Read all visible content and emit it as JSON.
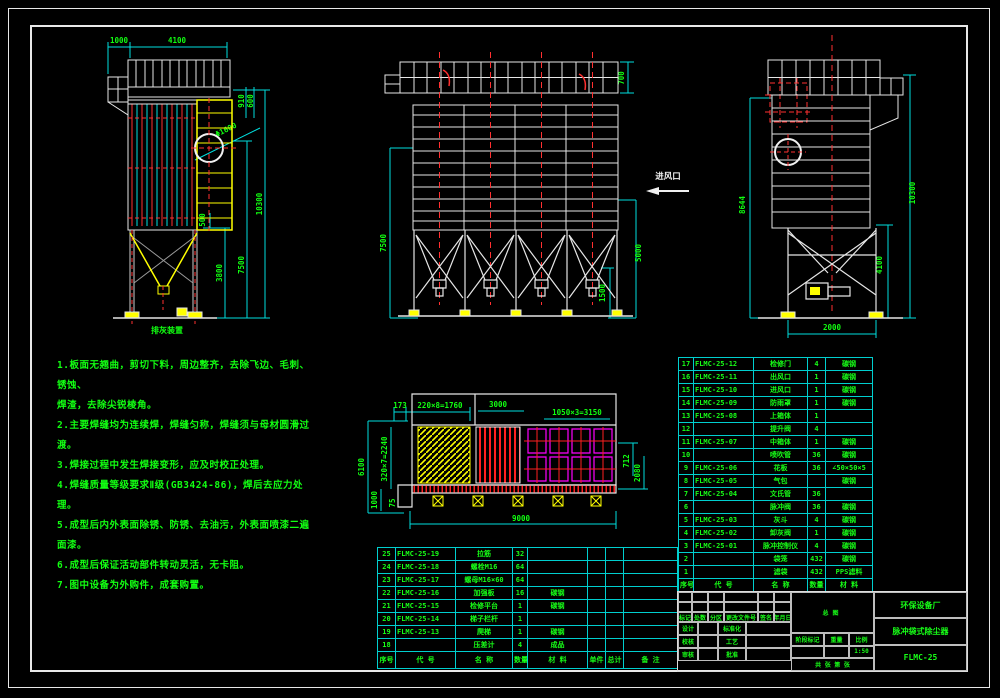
{
  "sheet": {
    "background": "#000000",
    "frame_color": "#e8e8e8",
    "grid_color": "#00cfcf",
    "text_green": "#11ff11",
    "accent_red": "#ff2020",
    "accent_yellow": "#ffff00",
    "accent_magenta": "#ff00ff"
  },
  "views": {
    "left": {
      "caption": "排灰装置",
      "dims": {
        "d1000": "1000",
        "d4100": "4100",
        "d910": "910",
        "d600": "600",
        "phi": "Φ1600",
        "d500": "500",
        "d3800": "3800",
        "d7500": "7500",
        "d10300": "10300"
      }
    },
    "front": {
      "inlet_label": "进风口",
      "dims": {
        "d700": "700",
        "d7500": "7500",
        "d5000": "5000",
        "d1500": "1500"
      }
    },
    "side": {
      "dims": {
        "d8644": "8644",
        "d10300": "10300",
        "d4100": "4100",
        "d2000": "2000"
      }
    },
    "plan": {
      "dims": {
        "d173": "173",
        "d1760": "220×8=1760",
        "d3000": "3000",
        "d3150": "1050×3=3150",
        "d6100": "6100",
        "d2240": "320×7=2240",
        "d1000": "1000",
        "d75": "75",
        "d9000": "9000",
        "d712": "712",
        "d2080": "2080"
      }
    }
  },
  "notes": {
    "lines": [
      "1.板面无翘曲，剪切下料，周边整齐，去除飞边、毛刺、锈蚀、",
      "焊渣，去除尖锐棱角。",
      "2.主要焊缝均为连续焊，焊缝匀称，焊缝须与母材圆滑过渡。",
      "3.焊接过程中发生焊接变形，应及时校正处理。",
      "4.焊缝质量等级要求Ⅱ级(GB3424-86)，焊后去应力处理。",
      "5.成型后内外表面除锈、防锈、去油污，外表面喷漆二遍面漆。",
      "6.成型后保证活动部件转动灵活，无卡阻。",
      "7.图中设备为外购件，成套购置。"
    ]
  },
  "bom_right": {
    "header": [
      "序号",
      "代 号",
      "名 称",
      "数量",
      "材 料"
    ],
    "rows": [
      [
        "17",
        "FLMC-25-12",
        "检修门",
        "4",
        "碳钢"
      ],
      [
        "16",
        "FLMC-25-11",
        "出风口",
        "1",
        "碳钢"
      ],
      [
        "15",
        "FLMC-25-10",
        "进风口",
        "1",
        "碳钢"
      ],
      [
        "14",
        "FLMC-25-09",
        "防雨罩",
        "1",
        "碳钢"
      ],
      [
        "13",
        "FLMC-25-08",
        "上箱体",
        "1",
        ""
      ],
      [
        "12",
        "",
        "提升阀",
        "4",
        ""
      ],
      [
        "11",
        "FLMC-25-07",
        "中箱体",
        "1",
        "碳钢"
      ],
      [
        "10",
        "",
        "喷吹管",
        "36",
        "碳钢"
      ],
      [
        "9",
        "FLMC-25-06",
        "花板",
        "36",
        "∠50×50×5"
      ],
      [
        "8",
        "FLMC-25-05",
        "气包",
        "",
        "碳钢"
      ],
      [
        "7",
        "FLMC-25-04",
        "文氏管",
        "36",
        ""
      ],
      [
        "6",
        "",
        "脉冲阀",
        "36",
        "碳钢"
      ],
      [
        "5",
        "FLMC-25-03",
        "灰斗",
        "4",
        "碳钢"
      ],
      [
        "4",
        "FLMC-25-02",
        "卸灰阀",
        "1",
        "碳钢"
      ],
      [
        "3",
        "FLMC-25-01",
        "脉冲控制仪",
        "4",
        "碳钢"
      ],
      [
        "2",
        "",
        "袋笼",
        "432",
        "碳钢"
      ],
      [
        "1",
        "",
        "滤袋",
        "432",
        "PPS滤料"
      ]
    ]
  },
  "bom_left": {
    "header": [
      "序号",
      "代 号",
      "名 称",
      "数量",
      "材 料",
      "单件",
      "总计",
      "备 注"
    ],
    "rows": [
      [
        "25",
        "FLMC-25-19",
        "拉筋",
        "32",
        "",
        "",
        "",
        ""
      ],
      [
        "24",
        "FLMC-25-18",
        "螺栓M16",
        "64",
        "",
        "",
        "",
        ""
      ],
      [
        "23",
        "FLMC-25-17",
        "螺母M16×60",
        "64",
        "",
        "",
        "",
        ""
      ],
      [
        "22",
        "FLMC-25-16",
        "加强板",
        "16",
        "碳钢",
        "",
        "",
        ""
      ],
      [
        "21",
        "FLMC-25-15",
        "检修平台",
        "1",
        "碳钢",
        "",
        "",
        ""
      ],
      [
        "20",
        "FLMC-25-14",
        "梯子栏杆",
        "1",
        "",
        "",
        "",
        ""
      ],
      [
        "19",
        "FLMC-25-13",
        "爬梯",
        "1",
        "碳钢",
        "",
        "",
        ""
      ],
      [
        "18",
        "",
        "压差计",
        "4",
        "成品",
        "",
        "",
        ""
      ]
    ]
  },
  "title_block": {
    "view_label": "总图",
    "stage_label": "阶段标记",
    "weight_label": "重量",
    "scale_label": "比例",
    "scale_value": "1:50",
    "sheets_label": "共 张 第 张",
    "company": "环保设备厂",
    "product": "脉冲袋式除尘器",
    "drawing_no": "FLMC-25",
    "rev_labels": [
      "标记",
      "处数",
      "分区",
      "更改文件号",
      "签名",
      "年月日"
    ],
    "sign_labels": [
      "设计",
      "校核",
      "审核",
      "标准化",
      "工艺",
      "批准"
    ]
  }
}
